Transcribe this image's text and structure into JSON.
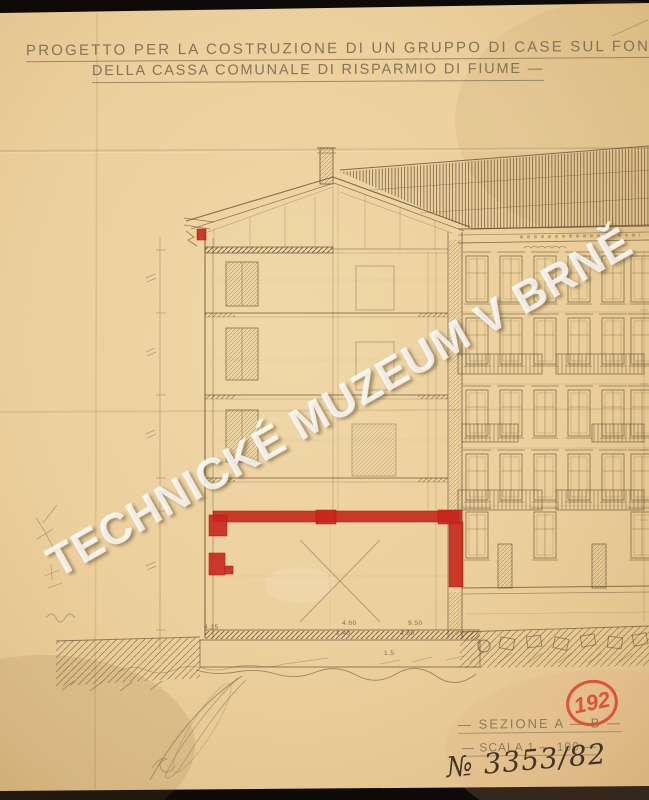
{
  "artwork": {
    "title_line1": "PROGETTO PER LA COSTRUZIONE DI UN GRUPPO DI CASE SUL FOND",
    "title_line2": "DELLA CASSA COMUNALE DI RISPARMIO DI FIUME —",
    "section_label": "— SEZIONE A — B —",
    "scale_label": "— SCALA 1 — 100 —",
    "archive_number": "№ 3353/82",
    "stamp_number": "192",
    "watermark": "TECHNICKÉ MUZEUM V BRNĚ",
    "annotations": {
      "dim_left": "4.35",
      "dim_top_a": "4.60",
      "dim_top_b": "9.50",
      "dim_bottom_a": "1.40",
      "dim_bottom_b": "4.50",
      "foundation_note": "1.5"
    },
    "colors": {
      "paper": "#ecd09c",
      "ink": "#6a5336",
      "pencil": "#85755b",
      "red_marking": "#c8271c",
      "stamp_red": "#dc4a33",
      "background": "#0d0a07"
    }
  }
}
